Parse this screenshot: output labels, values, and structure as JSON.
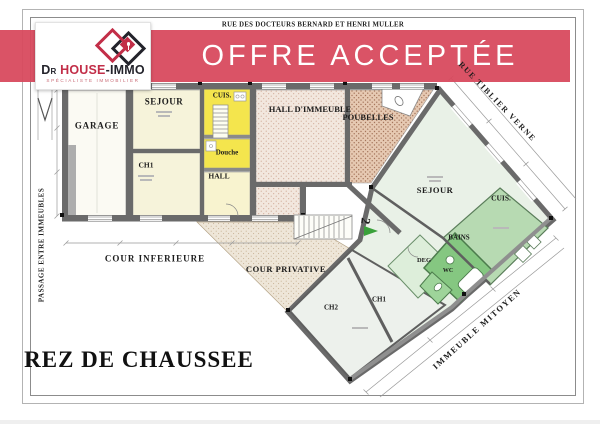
{
  "street_top": {
    "label": "RUE DES DOCTEURS BERNARD ET HENRI MULLER"
  },
  "banner": {
    "label": "OFFRE ACCEPTÉE",
    "color": "#d84a5e"
  },
  "logo": {
    "prefix": "D",
    "prefix_sup": "R",
    "word_main": "HOUSE",
    "word_suffix": "-IMMO",
    "tagline": "SPÉCIALISTE IMMOBILIER",
    "red": "#c22e48",
    "dark": "#23232b"
  },
  "plan": {
    "title": "REZ DE CHAUSSEE",
    "floor_marker": "2",
    "streets": {
      "passage": "PASSAGE ENTRE IMMEUBLES",
      "rue_diagonale": "RUE TIBLIER VERNE",
      "mitoyen": "IMMEUBLE MITOYEN"
    },
    "left_unit": {
      "garage": "GARAGE",
      "sejour": "SEJOUR",
      "ch1": "CH1",
      "cuisine": "CUIS.",
      "douche": "Douche",
      "hall": "HALL"
    },
    "common": {
      "hall_immeuble": "HALL D'IMMEUBLE",
      "poubelles": "POUBELLES"
    },
    "right_unit": {
      "sejour": "SEJOUR",
      "cuisine": "CUIS.",
      "bains": "BAINS",
      "degagement": "DEG",
      "wc": "WC",
      "ch1": "CH1",
      "ch2": "CH2"
    },
    "exterior": {
      "cour_inferieure": "COUR INFERIEURE",
      "cour_privative": "COUR PRIVATIVE"
    },
    "colors": {
      "wall": "#6a6a6a",
      "cream_room": "#f6f3da",
      "yellow_room": "#f4e54d",
      "green_light": "#e9f1e7",
      "green_mid": "#b7dab2",
      "green_dark": "#85c781"
    }
  }
}
